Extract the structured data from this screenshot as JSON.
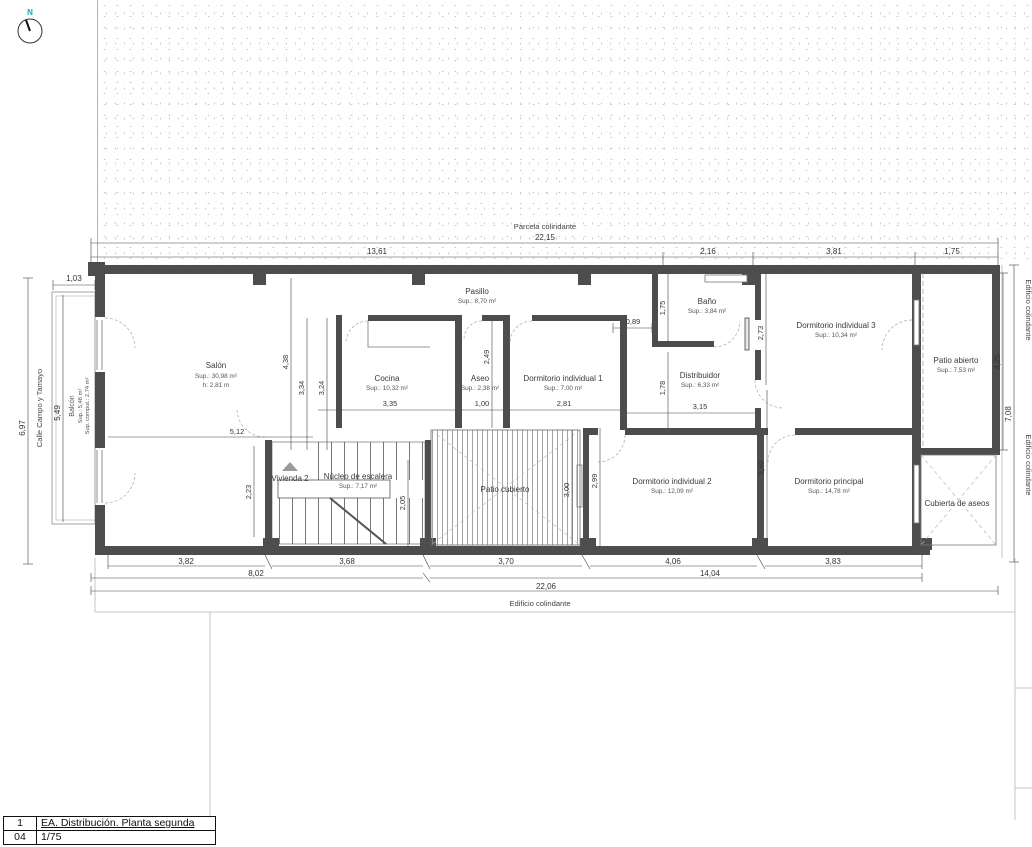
{
  "compass": {
    "north_label": "N"
  },
  "surroundings": {
    "top": "Parcela colindante",
    "bottom": "Edificio colindante",
    "right_a": "Edificio colindante",
    "right_b": "Edificio colindante",
    "street": "Calle Campo y Tamayo"
  },
  "rooms": {
    "salon": {
      "name": "Salón",
      "area": "Sup.: 30,98 m²",
      "height": "h: 2,81 m"
    },
    "cocina": {
      "name": "Cocina",
      "area": "Sup.: 10,32 m²"
    },
    "pasillo": {
      "name": "Pasillo",
      "area": "Sup.: 8,70 m²"
    },
    "aseo": {
      "name": "Aseo",
      "area": "Sup.: 2,38 m²"
    },
    "dormitorio1": {
      "name": "Dormitorio individual 1",
      "area": "Sup.: 7,00 m²"
    },
    "bano": {
      "name": "Baño",
      "area": "Sup.: 3,84 m²"
    },
    "distribuidor": {
      "name": "Distribuidor",
      "area": "Sup.: 6,33 m²"
    },
    "dormitorio3": {
      "name": "Dormitorio individual 3",
      "area": "Sup.: 10,34 m²"
    },
    "patio_abierto": {
      "name": "Patio abierto",
      "area": "Sup.: 7,53 m²"
    },
    "vivienda2": {
      "name": "Vivienda 2"
    },
    "nucleo": {
      "name": "Núcleo de escalera",
      "area": "Sup.: 7,17 m²"
    },
    "patio_cubierto": {
      "name": "Patio cubierto"
    },
    "dormitorio2": {
      "name": "Dormitorio individual 2",
      "area": "Sup.: 12,09 m²"
    },
    "principal": {
      "name": "Dormitorio principal",
      "area": "Sup.: 14,78 m²"
    },
    "cubierta": {
      "name": "Cubierta de aseos"
    },
    "balcon": {
      "name": "Balcón",
      "area": "Sup.: 5,48 m²",
      "computed": "Sup. comput.: 2,74 m²"
    }
  },
  "dims": {
    "top_overall": "22,15",
    "top_1": "13,61",
    "top_2": "2,16",
    "top_3": "3,81",
    "top_4": "1,75",
    "bottom_1": "3,82",
    "bottom_2": "3,68",
    "bottom_3": "3,70",
    "bottom_4": "4,06",
    "bottom_5": "3,83",
    "bottom_sub_1": "8,02",
    "bottom_sub_2": "14,04",
    "bottom_overall": "22,06",
    "left_1": "1,03",
    "left_2": "6,97",
    "left_3": "5,49",
    "right_1": "4,25",
    "right_2": "7,08",
    "salon_w": "5,12",
    "v438": "4,38",
    "v334": "3,34",
    "v324": "3,24",
    "cocina_w": "3,35",
    "aseo_w": "1,00",
    "dorm1_w": "2,81",
    "v249": "2,49",
    "bano_off": "0,89",
    "v175": "1,75",
    "v178": "1,78",
    "v273": "2,73",
    "distrib_w": "3,15",
    "v223": "2,23",
    "v205": "2,05",
    "v300": "3,00",
    "v299": "2,99",
    "v389": "3,89"
  },
  "title_block": {
    "row1_num": "1",
    "row1_title": "EA. Distribución. Planta segunda",
    "row2_num": "04",
    "row2_scale": "1/75"
  },
  "colors": {
    "wall": "#4d4d4d",
    "accent_north": "#17a9c4",
    "line": "#3c3c3c"
  }
}
